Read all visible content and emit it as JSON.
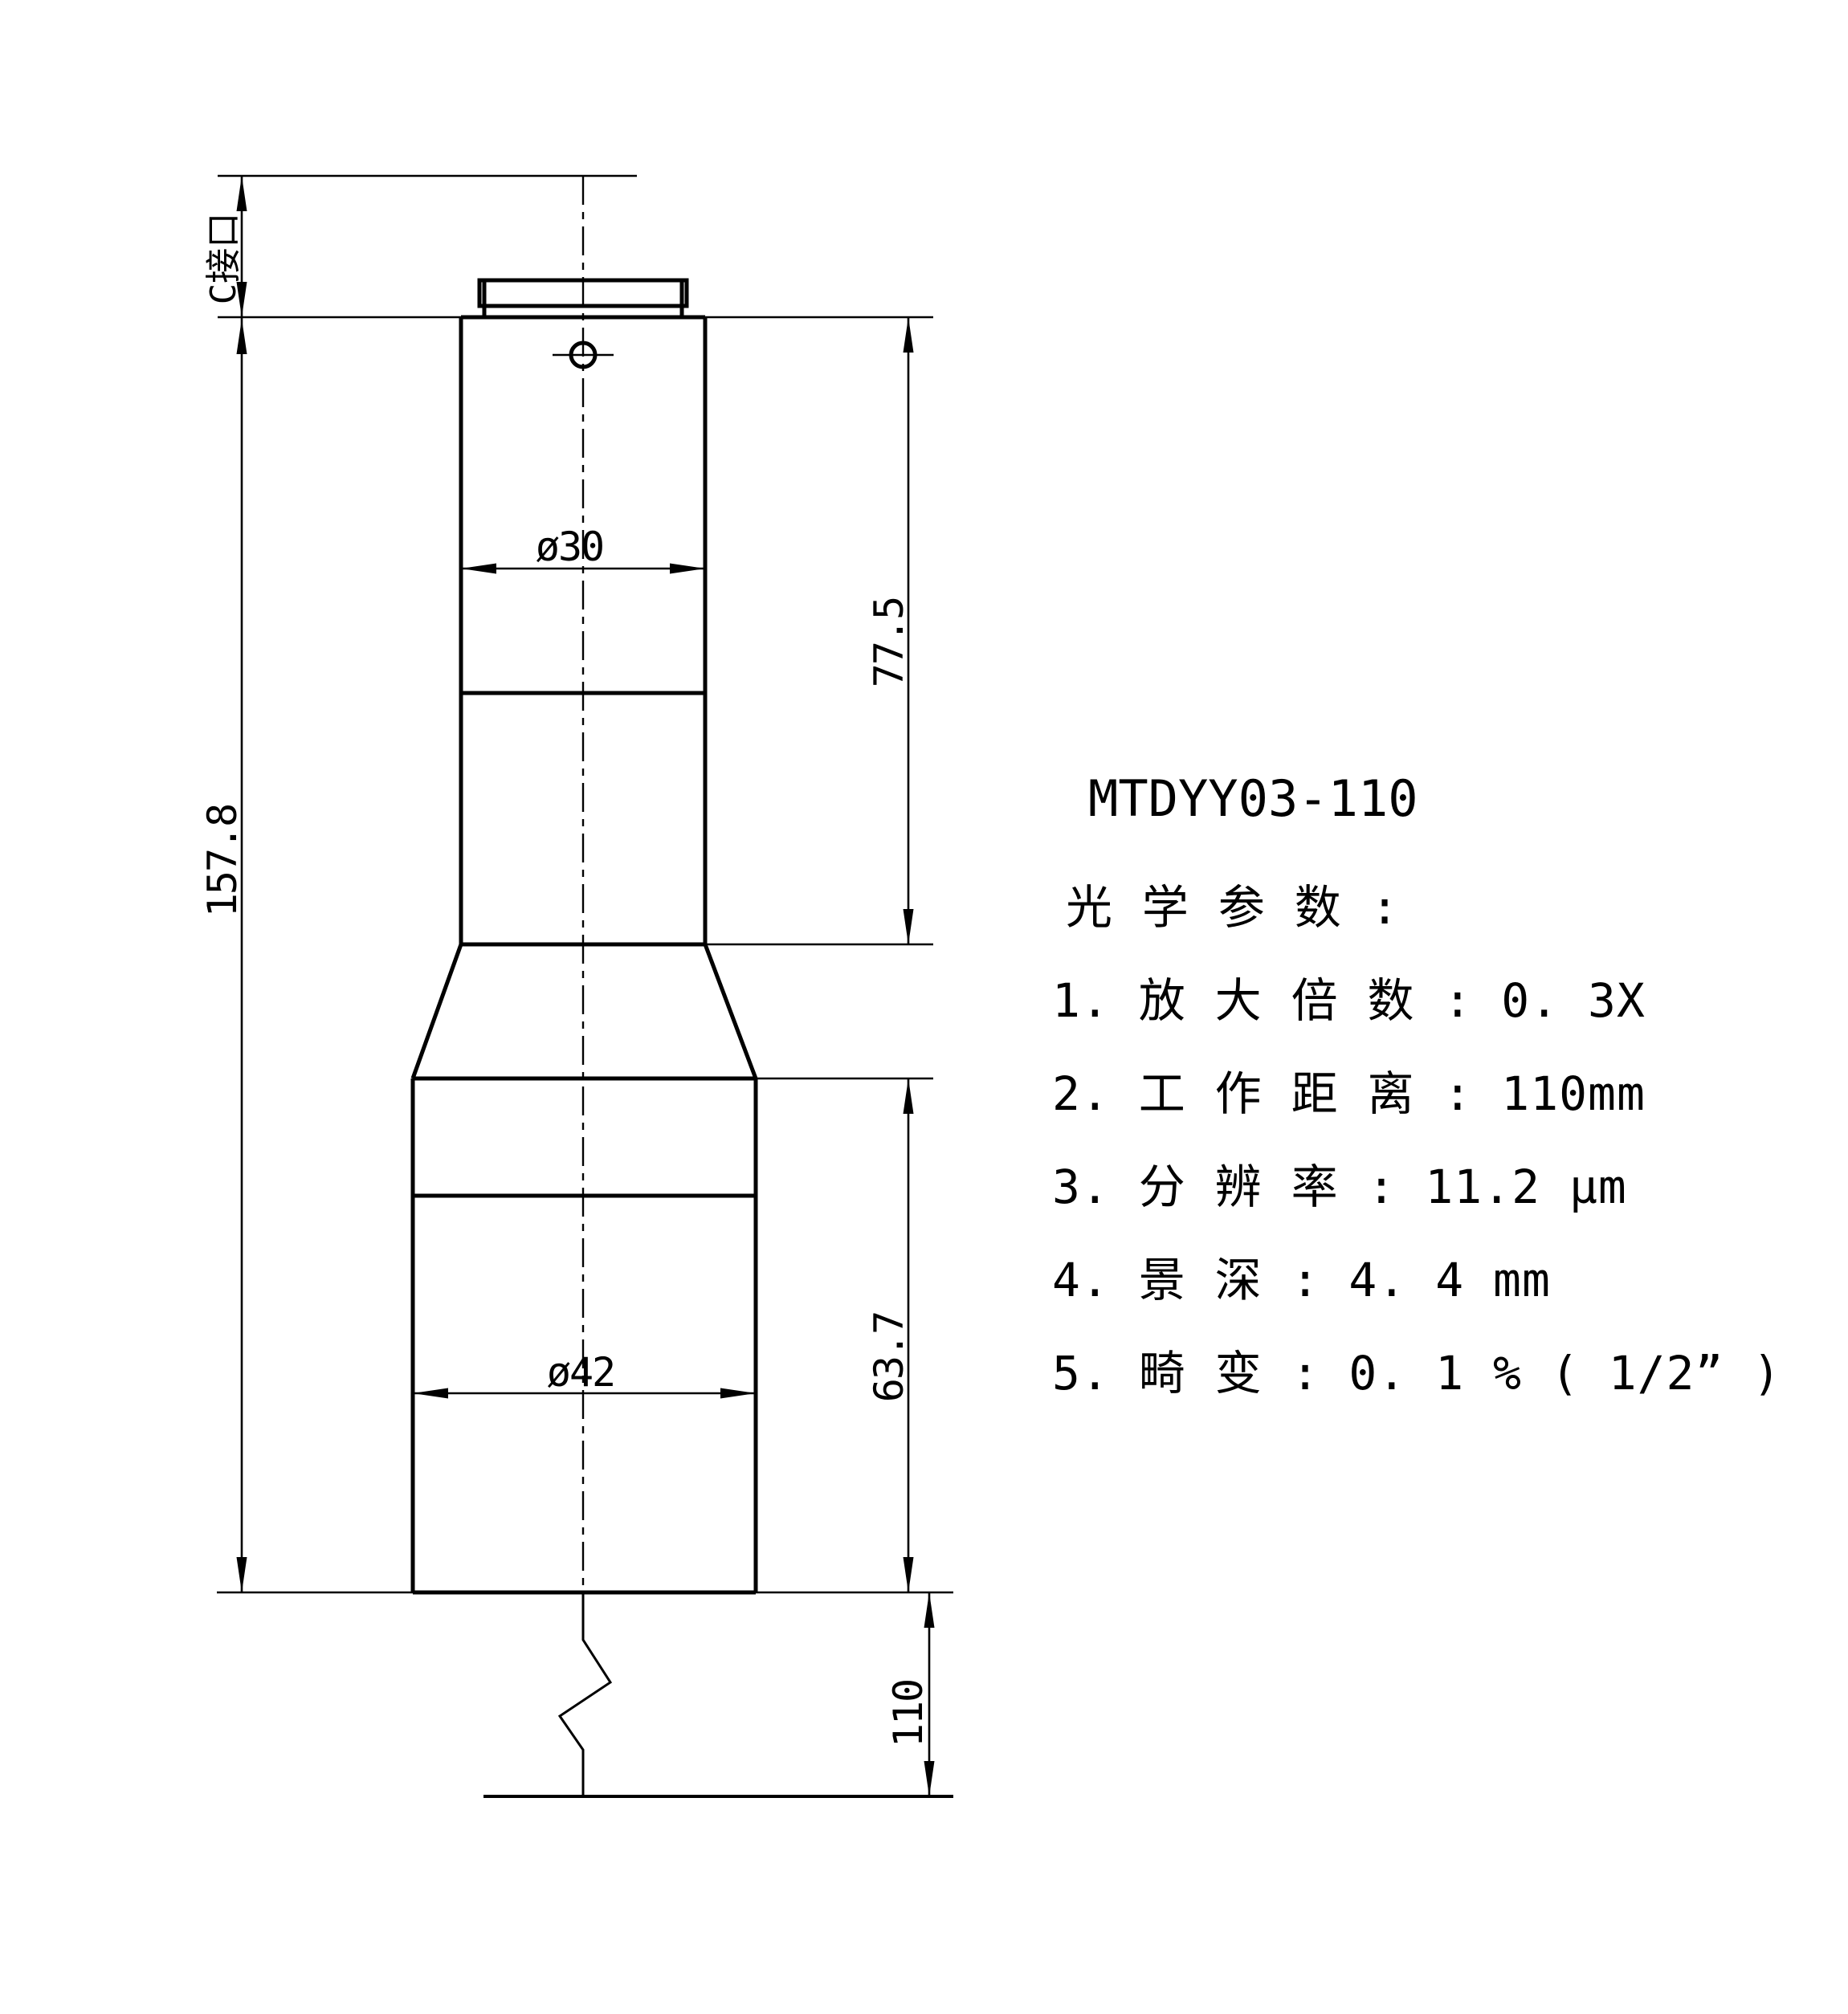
{
  "drawing": {
    "title": "MTDYY03-110",
    "dimensions": {
      "c_mount_label": "C接口",
      "overall_length": "157.8",
      "upper_diameter": "ø30",
      "upper_length": "77.5",
      "lower_diameter": "ø42",
      "lower_length": "63.7",
      "working_distance": "110"
    },
    "specs": {
      "heading": "光 学 参 数 :",
      "items": [
        "1. 放 大 倍 数 : 0. 3X",
        "2. 工 作 距 离 : 110mm",
        "3. 分 辨 率 : 11.2 μm",
        "4. 景 深 : 4. 4 mm",
        "5. 畸 变 : 0. 1 % ( 1/2” )"
      ]
    },
    "colors": {
      "ink": "#000000",
      "paper": "#ffffff"
    }
  }
}
